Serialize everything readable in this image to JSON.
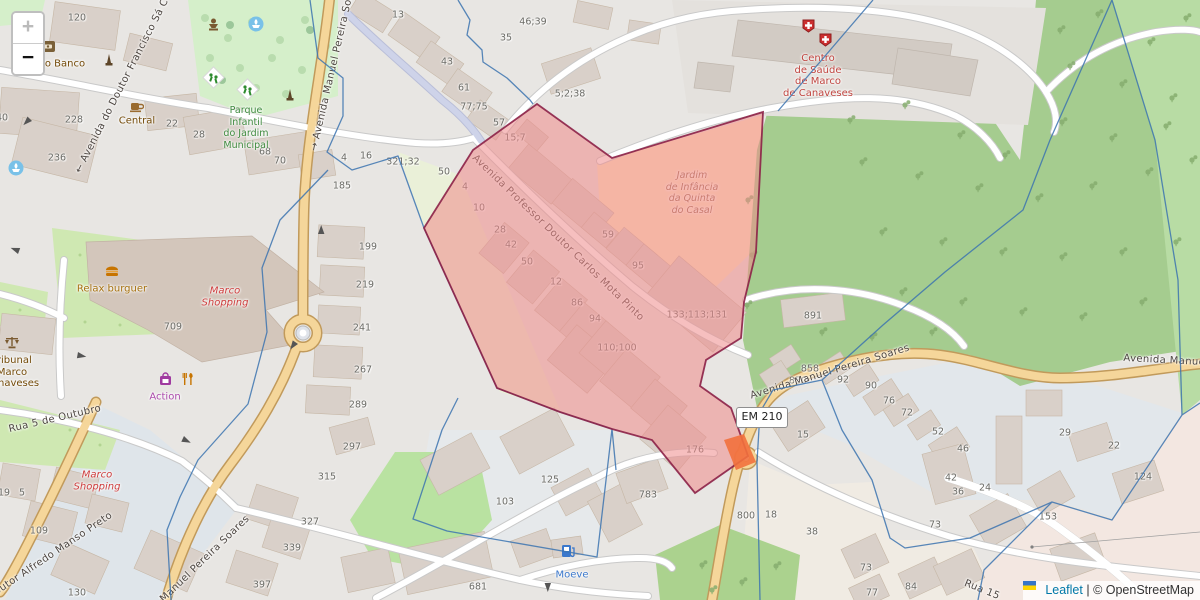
{
  "controls": {
    "zoom_in": "+",
    "zoom_out": "−"
  },
  "attribution": {
    "leaflet": "Leaflet",
    "separator": "|",
    "osm": "© OpenStreetMap"
  },
  "road_shield": {
    "label": "EM 210"
  },
  "colors": {
    "selection_fill": "#ee8a8a",
    "selection_border": "#8c2147",
    "boundary_line": "#3c74b0",
    "road_major": "#f5d69a",
    "road_casing": "#c19a5b",
    "forest": "#a5cc8f",
    "park": "#d5efca",
    "building": "#d9d0c9",
    "bluish_area": "#e2e7eb",
    "retail_area": "#f3e7e1",
    "leaflet_link": "#0078a8",
    "highlight_orange": "#f2713d",
    "living_street": "#ced3e9"
  },
  "street_labels": [
    {
      "name": "street-avenida-francisco-sa",
      "text": "← Avenida do Doutor Francisco Sá C",
      "x": 122,
      "y": 86,
      "rot": -63
    },
    {
      "name": "street-avenida-manuel-pereira-n",
      "text": "→ Avenida Manuel Pereira Soares",
      "x": 334,
      "y": 64,
      "rot": -77
    },
    {
      "name": "street-avenida-carlos-mota-pinto",
      "text": "Avenida Professor Doutor Carlos Mota Pinto",
      "x": 558,
      "y": 238,
      "rot": 44
    },
    {
      "name": "street-avenida-manuel-pereira-c",
      "text": "Avenida Manuel Pereira Soares",
      "x": 830,
      "y": 372,
      "rot": -17
    },
    {
      "name": "street-avenida-manuel-pereira-e",
      "text": "Avenida Manuel Pe",
      "x": 1174,
      "y": 361,
      "rot": 3
    },
    {
      "name": "street-rua-5-de-outubro",
      "text": "Rua 5 de Outubro",
      "x": 55,
      "y": 419,
      "rot": -13
    },
    {
      "name": "street-alfredo-manso-preto",
      "text": "Doutor Alfredo Manso Preto",
      "x": 50,
      "y": 556,
      "rot": -34
    },
    {
      "name": "street-manuel-pereira-s",
      "text": "Manuel Pereira Soares",
      "x": 205,
      "y": 559,
      "rot": -44
    },
    {
      "name": "street-rua-se",
      "text": "Rua 15",
      "x": 982,
      "y": 590,
      "rot": 22
    }
  ],
  "poi_labels": [
    {
      "name": "poi-novo-banco",
      "lines": [
        "vo Banco"
      ],
      "x": 62,
      "y": 64,
      "color": "#734a08"
    },
    {
      "name": "poi-central",
      "lines": [
        "Central"
      ],
      "x": 137,
      "y": 121,
      "color": "#734a08"
    },
    {
      "name": "poi-parque-infantil",
      "lines": [
        "Parque",
        "Infantil",
        "do Jardim",
        "Municipal"
      ],
      "x": 246,
      "y": 128,
      "color": "#3e8a3e",
      "size": 9.5
    },
    {
      "name": "poi-relax-burguer",
      "lines": [
        "Relax burguer"
      ],
      "x": 112,
      "y": 289,
      "color": "#a5700e"
    },
    {
      "name": "poi-marco-shopping-1",
      "lines": [
        "Marco",
        "Shopping"
      ],
      "x": 225,
      "y": 297,
      "color": "#ce3d3d",
      "italic": true
    },
    {
      "name": "poi-tribunal",
      "lines": [
        "Tribunal",
        "Marco",
        "Canaveses"
      ],
      "x": 12,
      "y": 372,
      "color": "#734a08"
    },
    {
      "name": "poi-action",
      "lines": [
        "Action"
      ],
      "x": 165,
      "y": 397,
      "color": "#ab4aab"
    },
    {
      "name": "poi-marco-shopping-2",
      "lines": [
        "Marco",
        "Shopping"
      ],
      "x": 97,
      "y": 481,
      "color": "#ce3d3d",
      "italic": true
    },
    {
      "name": "poi-moeve",
      "lines": [
        "Moeve"
      ],
      "x": 572,
      "y": 575,
      "color": "#3b78cc"
    },
    {
      "name": "poi-centro-saude",
      "lines": [
        "Centro",
        "de Saúde",
        "de Marco",
        "de Canaveses"
      ],
      "x": 818,
      "y": 76,
      "color": "#c04540"
    },
    {
      "name": "poi-jardim-infancia",
      "lines": [
        "Jardim",
        "de Infância",
        "da Quinta",
        "do Casal"
      ],
      "x": 692,
      "y": 193,
      "color": "#9c6b4e",
      "italic": true,
      "size": 9.5
    }
  ],
  "house_numbers": [
    {
      "t": "120",
      "x": 77,
      "y": 18
    },
    {
      "t": "40",
      "x": 2,
      "y": 118
    },
    {
      "t": "228",
      "x": 74,
      "y": 120
    },
    {
      "t": "22",
      "x": 172,
      "y": 124
    },
    {
      "t": "28",
      "x": 199,
      "y": 135
    },
    {
      "t": "236",
      "x": 57,
      "y": 158
    },
    {
      "t": "68",
      "x": 265,
      "y": 152
    },
    {
      "t": "70",
      "x": 280,
      "y": 161
    },
    {
      "t": "13",
      "x": 398,
      "y": 15
    },
    {
      "t": "46;39",
      "x": 533,
      "y": 22
    },
    {
      "t": "35",
      "x": 506,
      "y": 38
    },
    {
      "t": "43",
      "x": 447,
      "y": 62
    },
    {
      "t": "61",
      "x": 464,
      "y": 88
    },
    {
      "t": "77;75",
      "x": 474,
      "y": 107
    },
    {
      "t": "57",
      "x": 499,
      "y": 123
    },
    {
      "t": "5;2;38",
      "x": 570,
      "y": 94
    },
    {
      "t": "15;7",
      "x": 515,
      "y": 138
    },
    {
      "t": "4",
      "x": 344,
      "y": 158
    },
    {
      "t": "16",
      "x": 366,
      "y": 156
    },
    {
      "t": "321;32",
      "x": 403,
      "y": 162
    },
    {
      "t": "50",
      "x": 444,
      "y": 172
    },
    {
      "t": "185",
      "x": 342,
      "y": 186
    },
    {
      "t": "4",
      "x": 465,
      "y": 187
    },
    {
      "t": "10",
      "x": 479,
      "y": 208
    },
    {
      "t": "28",
      "x": 500,
      "y": 230
    },
    {
      "t": "42",
      "x": 511,
      "y": 245
    },
    {
      "t": "50",
      "x": 527,
      "y": 262
    },
    {
      "t": "12",
      "x": 556,
      "y": 282
    },
    {
      "t": "86",
      "x": 577,
      "y": 303
    },
    {
      "t": "94",
      "x": 595,
      "y": 319
    },
    {
      "t": "59",
      "x": 608,
      "y": 235
    },
    {
      "t": "95",
      "x": 638,
      "y": 266
    },
    {
      "t": "110;100",
      "x": 617,
      "y": 348
    },
    {
      "t": "133;113;131",
      "x": 697,
      "y": 315
    },
    {
      "t": "199",
      "x": 368,
      "y": 247
    },
    {
      "t": "219",
      "x": 365,
      "y": 285
    },
    {
      "t": "241",
      "x": 362,
      "y": 328
    },
    {
      "t": "267",
      "x": 363,
      "y": 370
    },
    {
      "t": "289",
      "x": 358,
      "y": 405
    },
    {
      "t": "709",
      "x": 173,
      "y": 327
    },
    {
      "t": "891",
      "x": 813,
      "y": 316
    },
    {
      "t": "858",
      "x": 810,
      "y": 369
    },
    {
      "t": "850",
      "x": 798,
      "y": 381
    },
    {
      "t": "92",
      "x": 843,
      "y": 380
    },
    {
      "t": "90",
      "x": 871,
      "y": 386
    },
    {
      "t": "76",
      "x": 889,
      "y": 401
    },
    {
      "t": "72",
      "x": 907,
      "y": 413
    },
    {
      "t": "52",
      "x": 938,
      "y": 432
    },
    {
      "t": "46",
      "x": 963,
      "y": 449
    },
    {
      "t": "15",
      "x": 803,
      "y": 435
    },
    {
      "t": "29",
      "x": 1065,
      "y": 433
    },
    {
      "t": "22",
      "x": 1114,
      "y": 446
    },
    {
      "t": "42",
      "x": 951,
      "y": 478
    },
    {
      "t": "36",
      "x": 958,
      "y": 492
    },
    {
      "t": "24",
      "x": 985,
      "y": 488
    },
    {
      "t": "73",
      "x": 935,
      "y": 525
    },
    {
      "t": "84",
      "x": 911,
      "y": 587
    },
    {
      "t": "73",
      "x": 866,
      "y": 568
    },
    {
      "t": "77",
      "x": 872,
      "y": 593
    },
    {
      "t": "124",
      "x": 1143,
      "y": 477
    },
    {
      "t": "153",
      "x": 1048,
      "y": 517
    },
    {
      "t": "800",
      "x": 746,
      "y": 516
    },
    {
      "t": "18",
      "x": 771,
      "y": 515
    },
    {
      "t": "38",
      "x": 812,
      "y": 532
    },
    {
      "t": "176",
      "x": 695,
      "y": 450
    },
    {
      "t": "783",
      "x": 648,
      "y": 495
    },
    {
      "t": "297",
      "x": 352,
      "y": 447
    },
    {
      "t": "125",
      "x": 550,
      "y": 480
    },
    {
      "t": "103",
      "x": 505,
      "y": 502
    },
    {
      "t": "681",
      "x": 478,
      "y": 587
    },
    {
      "t": "19",
      "x": 4,
      "y": 493
    },
    {
      "t": "5",
      "x": 22,
      "y": 493
    },
    {
      "t": "109",
      "x": 39,
      "y": 531
    },
    {
      "t": "130",
      "x": 77,
      "y": 593
    },
    {
      "t": "327",
      "x": 310,
      "y": 522
    },
    {
      "t": "339",
      "x": 292,
      "y": 548
    },
    {
      "t": "397",
      "x": 262,
      "y": 585
    },
    {
      "t": "315",
      "x": 327,
      "y": 477
    }
  ]
}
